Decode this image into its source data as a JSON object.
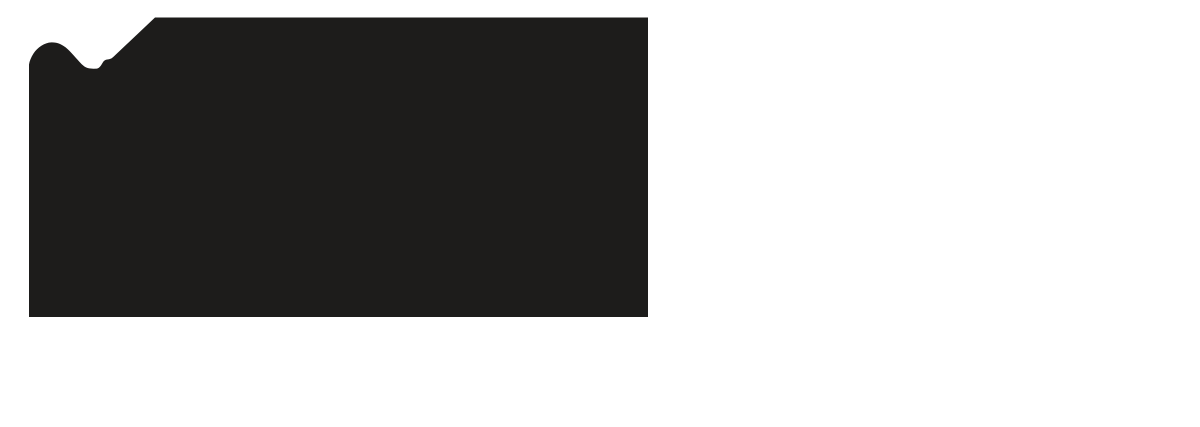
{
  "canvas": {
    "width_px": 1200,
    "height_px": 427,
    "background_color": "#ffffff"
  },
  "silhouette": {
    "fill_color": "#1d1c1b",
    "path": "M 29 317 L 29 64.5 C 29.5 61 31 57.5 33.5 53.5 C 37.5 47.5 44.5 42.6 51.5 42.4 C 57.5 42.3 62.5 44.5 67.5 49 C 73.5 54.5 78.5 61.5 83.5 65.8 C 86.5 68.2 89.5 68.7 93.5 68.7 L 97 68.6 C 99.5 68 101 65.5 102.5 63 C 103.5 61.3 104.5 60.3 106 59.8 C 107.5 59.4 109 59.4 110.5 58.8 C 111.5 58.4 112.5 57.6 113.5 56.7 L 155 17.5 L 648 17.5 L 648 317 Z"
  },
  "chart_data": {
    "type": "area",
    "title": "",
    "xlabel": "",
    "ylabel": "",
    "legend": false,
    "grid": false,
    "axes_visible": false,
    "fill_color": "#1d1c1b",
    "background_color": "#ffffff",
    "plot_area_px": {
      "left": 29,
      "right": 648,
      "top_plateau_y": 17.5,
      "baseline_y": 317
    },
    "ylim": [
      0,
      100
    ],
    "series": [
      {
        "name": "area-silhouette-profile",
        "points": [
          {
            "x_px": 29,
            "y_px": 64.5,
            "value_pct": 84.3
          },
          {
            "x_px": 34,
            "y_px": 53.0,
            "value_pct": 88.1
          },
          {
            "x_px": 43,
            "y_px": 44.0,
            "value_pct": 91.1
          },
          {
            "x_px": 52,
            "y_px": 42.4,
            "value_pct": 91.7
          },
          {
            "x_px": 62,
            "y_px": 44.5,
            "value_pct": 91.0
          },
          {
            "x_px": 74,
            "y_px": 54.5,
            "value_pct": 87.6
          },
          {
            "x_px": 84,
            "y_px": 66.0,
            "value_pct": 83.8
          },
          {
            "x_px": 91,
            "y_px": 68.7,
            "value_pct": 82.9
          },
          {
            "x_px": 97,
            "y_px": 68.6,
            "value_pct": 82.9
          },
          {
            "x_px": 102,
            "y_px": 63.5,
            "value_pct": 84.6
          },
          {
            "x_px": 106,
            "y_px": 59.8,
            "value_pct": 85.9
          },
          {
            "x_px": 110,
            "y_px": 59.0,
            "value_pct": 86.1
          },
          {
            "x_px": 114,
            "y_px": 56.3,
            "value_pct": 87.0
          },
          {
            "x_px": 135,
            "y_px": 36.5,
            "value_pct": 93.7
          },
          {
            "x_px": 155,
            "y_px": 17.5,
            "value_pct": 100
          },
          {
            "x_px": 648,
            "y_px": 17.5,
            "value_pct": 100
          }
        ]
      }
    ],
    "notes": "Solid black filled area on white: rounded hill peaking near x=52, dip to valley near x=91-97, small shoulder near x=106-110, straight steep rise to a flat maximum plateau from x=155 to x=648; sharp vertical right edge and flat bottom baseline at y=317."
  }
}
